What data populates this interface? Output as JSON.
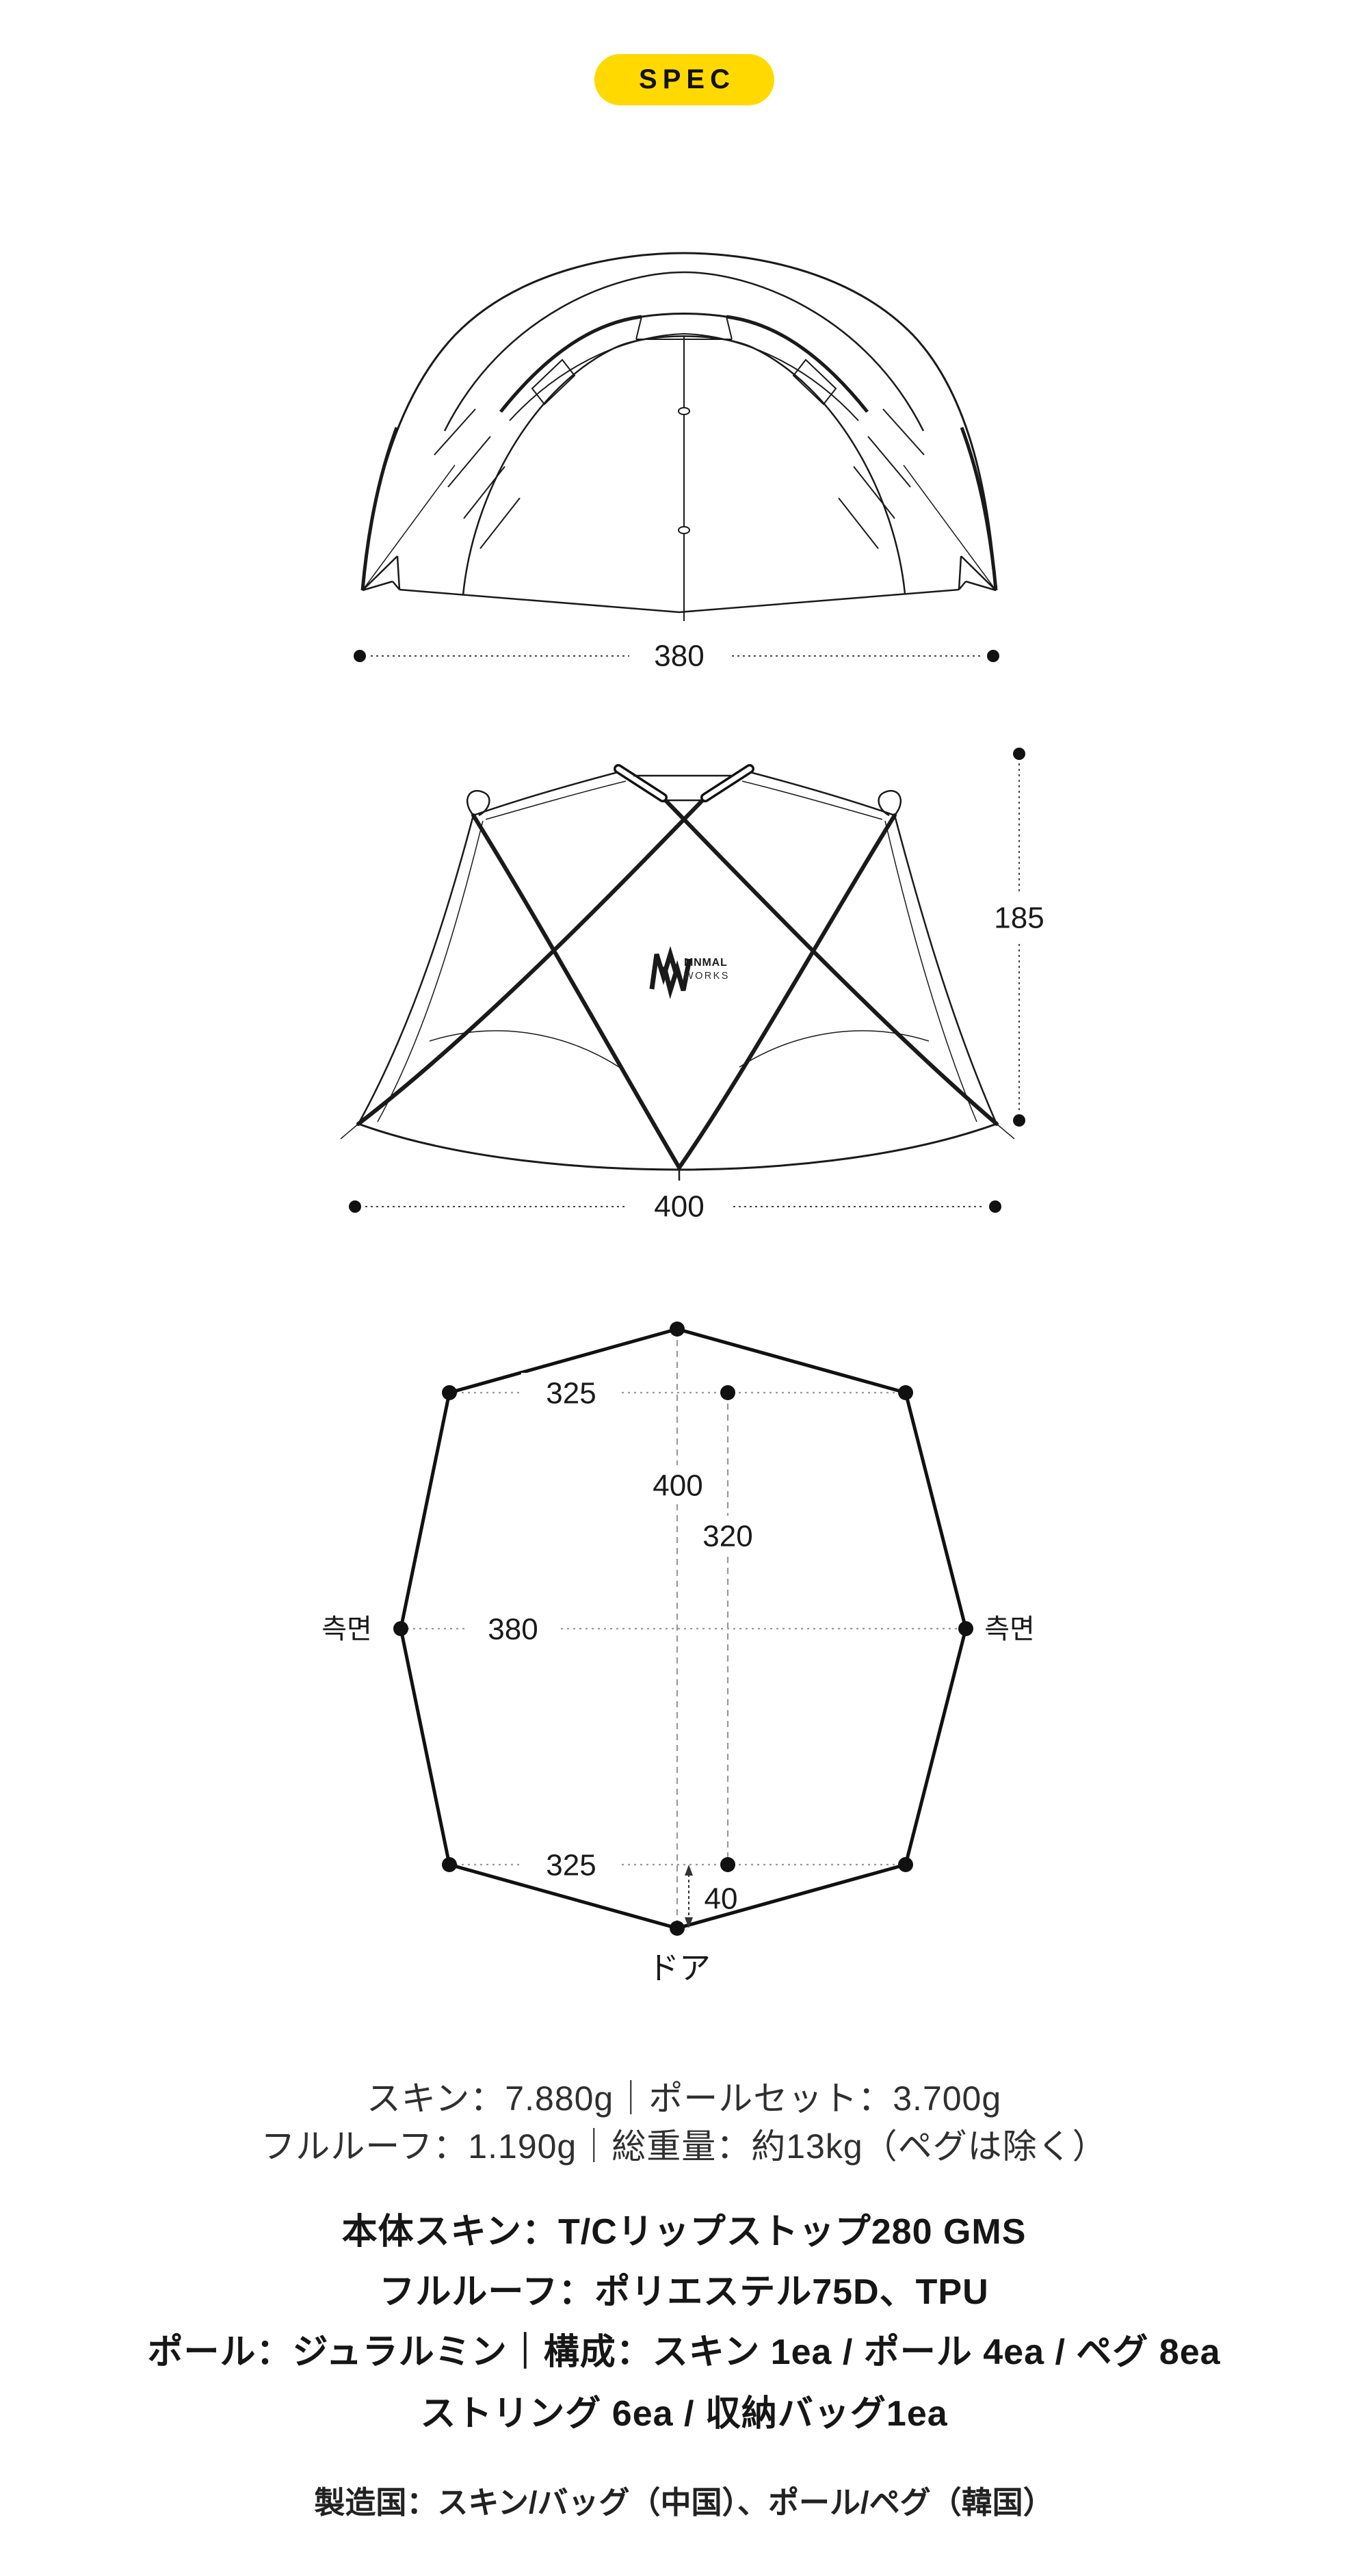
{
  "badge": {
    "label": "SPEC",
    "bg": "#FFD900",
    "text_color": "#111111"
  },
  "logo": {
    "line1": "MNMAL",
    "line2": "WORKS"
  },
  "figures": {
    "front_view": {
      "width_label": "380"
    },
    "side_view": {
      "height_label": "185",
      "width_label": "400"
    },
    "floor_plan": {
      "top_width_label": "325",
      "length_label": "400",
      "inner_length_label": "320",
      "mid_width_label": "380",
      "bottom_width_label": "325",
      "door_offset_label": "40",
      "side_label_left": "측면",
      "side_label_right": "측면",
      "door_label": "ドア"
    }
  },
  "specs": {
    "weight_line1": "スキン：7.880g｜ポールセット：3.700g",
    "weight_line2": "フルルーフ：1.190g｜総重量：約13kg（ペグは除く）",
    "material_lines": [
      "本体スキン：T/Cリップストップ280 GMS",
      "フルルーフ：ポリエステル75D、TPU",
      "ポール：ジュラルミン｜構成：スキン 1ea / ポール 4ea / ペグ 8ea",
      "ストリング 6ea / 収納バッグ1ea"
    ],
    "origin_line": "製造国：スキン/バッグ（中国）、ポール/ペグ（韓国）"
  },
  "colors": {
    "ink": "#1a1a1a",
    "dim_line": "#444444",
    "guide_line": "#999999",
    "badge_bg": "#FFD900"
  }
}
